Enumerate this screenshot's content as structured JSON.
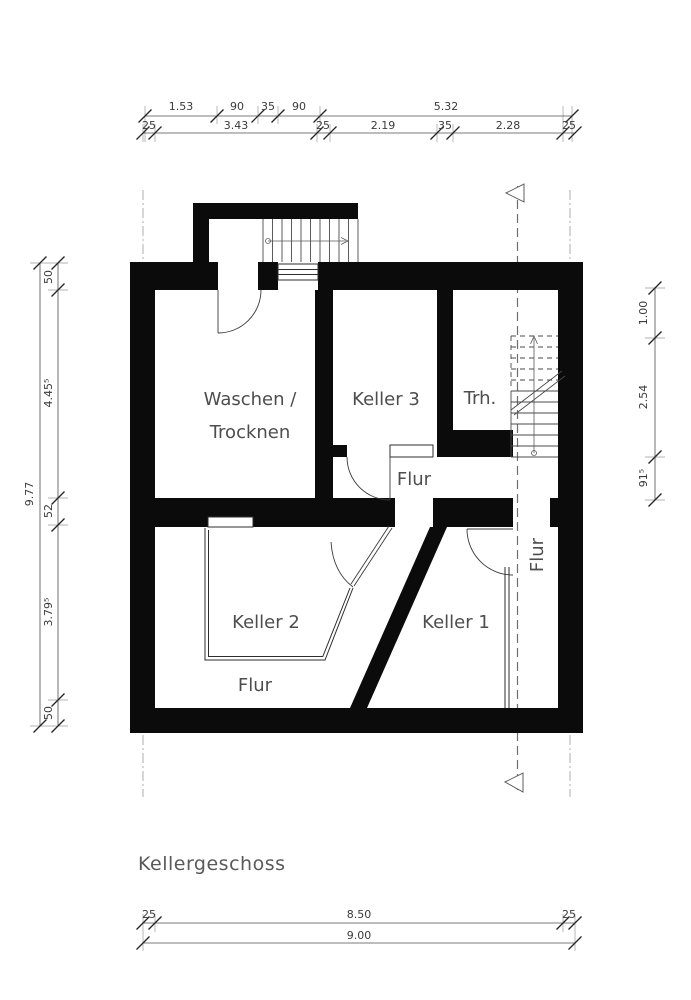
{
  "title": "Kellergeschoss",
  "rooms": {
    "waschen_line1": "Waschen /",
    "waschen_line2": "Trocknen",
    "keller3": "Keller 3",
    "trh": "Trh.",
    "flur_center": "Flur",
    "keller2": "Keller 2",
    "keller1": "Keller 1",
    "flur_southwest": "Flur",
    "flur_east": "Flur"
  },
  "dimensions": {
    "top_row1": [
      "1.53",
      "90",
      "35",
      "90",
      "5.32"
    ],
    "top_row2": [
      "25",
      "3.43",
      "25",
      "2.19",
      "35",
      "2.28",
      "25"
    ],
    "left_outer": "9.77",
    "left_inner": [
      "50",
      "4.45⁵",
      "52",
      "3.79⁵",
      "50"
    ],
    "right": [
      "1.00",
      "2.54",
      "91⁵"
    ],
    "bottom_row1": [
      "25",
      "8.50",
      "25"
    ],
    "bottom_row2": "9.00"
  },
  "colors": {
    "wall": "#0b0b0b",
    "text": "#4d4d4d",
    "background": "#ffffff"
  }
}
